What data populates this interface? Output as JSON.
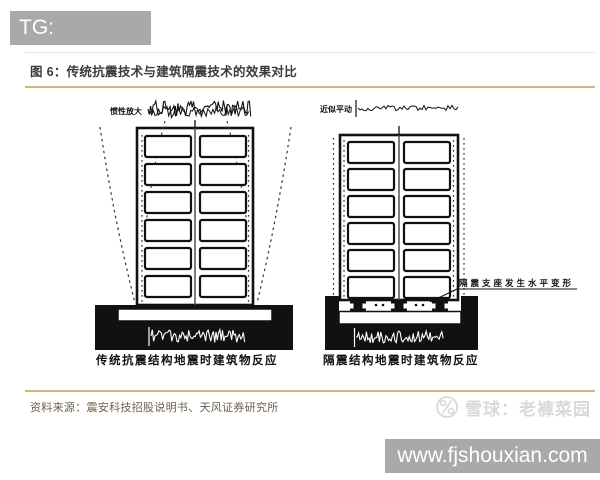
{
  "badge": {
    "text": "TG: MYYJJPP"
  },
  "figure": {
    "title": "图 6：传统抗震技术与建筑隔震技术的效果对比",
    "source": "资料来源：震安科技招股说明书、天风证券研究所",
    "left_diagram": {
      "top_label": "惯性放大",
      "caption": "传统抗震结构地震时建筑物反应"
    },
    "right_diagram": {
      "top_label": "近似平动",
      "bearing_label": "隔震支座发生水平变形",
      "caption": "隔震结构地震时建筑物反应"
    }
  },
  "watermark": {
    "text": "雪球：老褲菜园"
  },
  "footer": {
    "url": "www.fjshouxian.com"
  },
  "colors": {
    "badge_bg": "#a9a9a9",
    "accent_line": "#cdb87e",
    "title_text": "#3b3b3b",
    "source_text": "#6b5f4e",
    "watermark_text": "#d9d9d9",
    "footer_bg": "#a9a9a9",
    "diagram_ink": "#111111"
  }
}
